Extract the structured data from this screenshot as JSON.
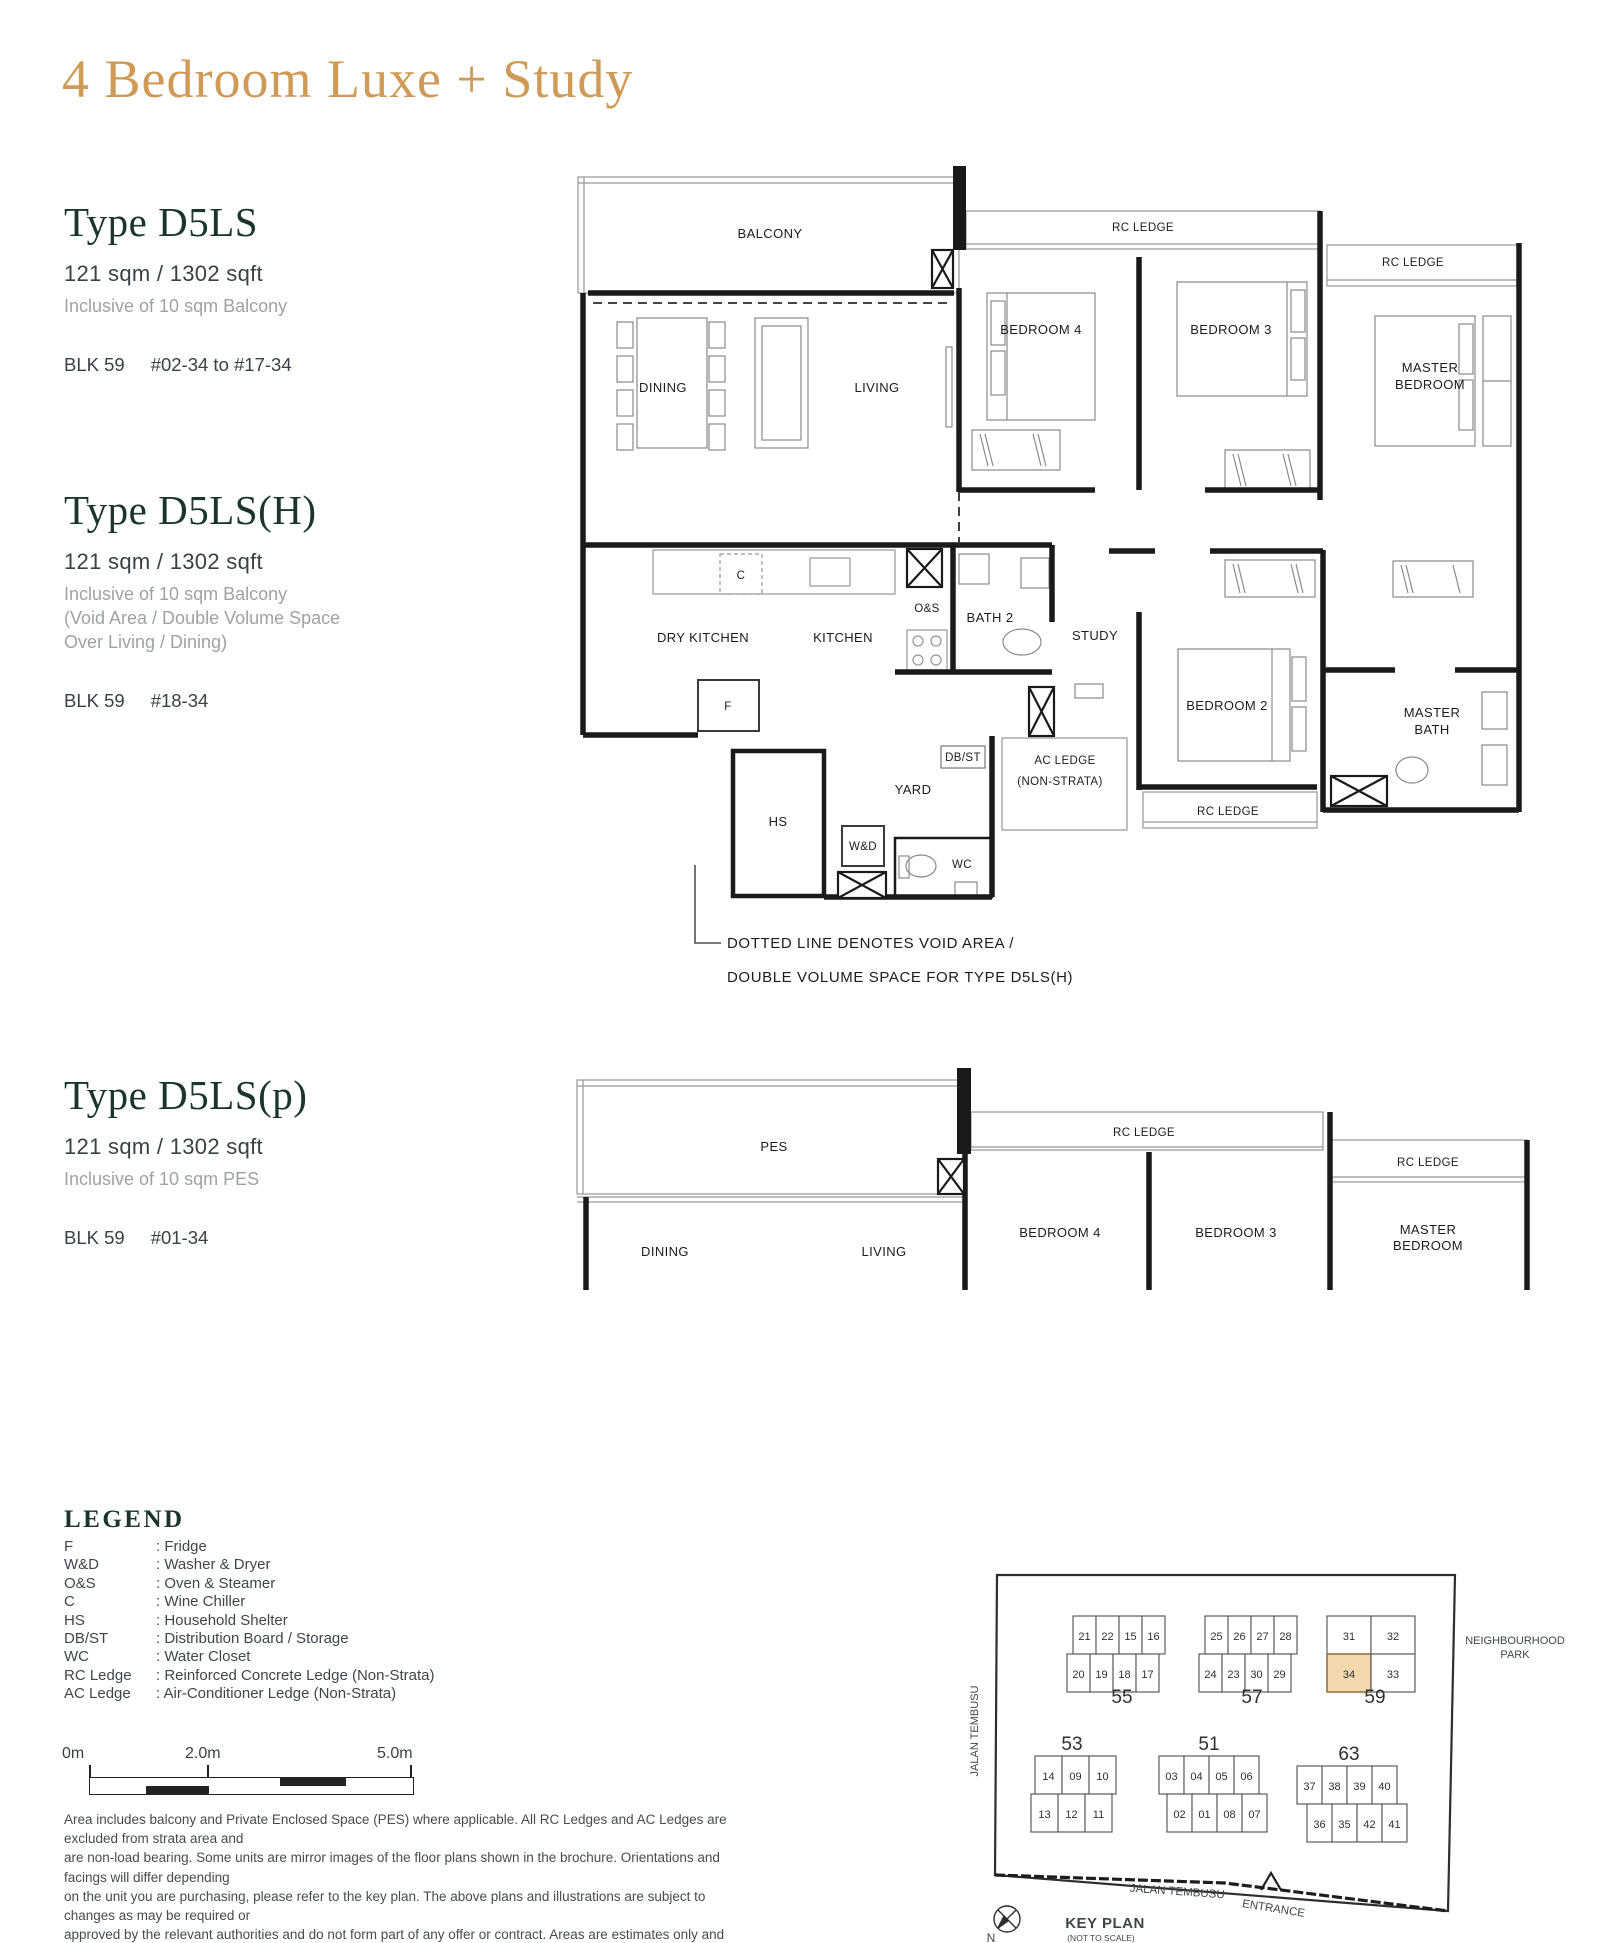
{
  "page": {
    "title": "4 Bedroom Luxe + Study"
  },
  "types": [
    {
      "name": "Type D5LS",
      "area": "121 sqm / 1302 sqft",
      "inc": [
        "Inclusive of 10 sqm Balcony"
      ],
      "blk": "BLK 59",
      "units": "#02-34 to #17-34"
    },
    {
      "name": "Type D5LS(H)",
      "area": "121 sqm / 1302 sqft",
      "inc": [
        "Inclusive of 10 sqm Balcony",
        "(Void Area / Double Volume Space",
        "Over Living / Dining)"
      ],
      "blk": "BLK 59",
      "units": "#18-34"
    },
    {
      "name": "Type D5LS(p)",
      "area": "121 sqm / 1302 sqft",
      "inc": [
        "Inclusive of 10 sqm PES"
      ],
      "blk": "BLK 59",
      "units": "#01-34"
    }
  ],
  "plan1": {
    "balcony": "BALCONY",
    "rc_a": "RC LEDGE",
    "rc_b": "RC LEDGE",
    "rc_c": "RC LEDGE",
    "dining": "DINING",
    "living": "LIVING",
    "bedroom4": "BEDROOM 4",
    "bedroom3": "BEDROOM 3",
    "master1": "MASTER",
    "master2": "BEDROOM",
    "c": "C",
    "os": "O&S",
    "dry_kitchen": "DRY KITCHEN",
    "kitchen": "KITCHEN",
    "bath2": "BATH 2",
    "study": "STUDY",
    "f": "F",
    "dbst": "DB/ST",
    "ac1": "AC LEDGE",
    "ac2": "(NON-STRATA)",
    "yard": "YARD",
    "hs": "HS",
    "wd": "W&D",
    "wc": "WC",
    "bedroom2": "BEDROOM 2",
    "mbath1": "MASTER",
    "mbath2": "BATH",
    "note1": "DOTTED LINE DENOTES VOID AREA /",
    "note2": "DOUBLE VOLUME SPACE FOR TYPE D5LS(H)"
  },
  "plan2": {
    "pes": "PES",
    "rc_a": "RC LEDGE",
    "rc_b": "RC LEDGE",
    "dining": "DINING",
    "living": "LIVING",
    "bedroom4": "BEDROOM 4",
    "bedroom3": "BEDROOM 3",
    "master1": "MASTER",
    "master2": "BEDROOM"
  },
  "legend": {
    "heading": "LEGEND",
    "items": [
      {
        "k": "F",
        "v": ": Fridge"
      },
      {
        "k": "W&D",
        "v": ": Washer & Dryer"
      },
      {
        "k": "O&S",
        "v": ": Oven & Steamer"
      },
      {
        "k": "C",
        "v": ": Wine Chiller"
      },
      {
        "k": "HS",
        "v": ": Household Shelter"
      },
      {
        "k": "DB/ST",
        "v": ": Distribution Board / Storage"
      },
      {
        "k": "WC",
        "v": ": Water Closet"
      },
      {
        "k": "RC Ledge",
        "v": ": Reinforced Concrete Ledge (Non-Strata)"
      },
      {
        "k": "AC Ledge",
        "v": ": Air-Conditioner Ledge (Non-Strata)"
      }
    ]
  },
  "scalebar": {
    "l0": "0m",
    "l1": "2.0m",
    "l2": "5.0m"
  },
  "disclaimer": {
    "lines": [
      "Area includes balcony and Private Enclosed Space (PES) where applicable. All RC Ledges and AC Ledges are excluded from strata area and",
      "are non-load bearing. Some units are mirror images of the floor plans shown in the brochure. Orientations and facings will differ depending",
      "on the unit you are purchasing, please refer to the key plan. The above plans and illustrations are subject to changes as may be required or",
      "approved by the relevant authorities and do not form part of any offer or contract. Areas are estimates only and are subject to final survey.",
      "The balcony & PES shall not be enclosed unless with the approved balcony screen. For an illustration of the approved balcony screen,",
      "please refer to Annex A of this brochure."
    ]
  },
  "keyplan": {
    "highlight": "34",
    "highlight_color": "#f5d9ae",
    "labels": {
      "neigh1": "NEIGHBOURHOOD",
      "neigh2": "PARK",
      "jalan_left": "JALAN TEMBUSU",
      "jalan_bottom": "JALAN TEMBUSU",
      "entrance": "ENTRANCE",
      "keyplan": "KEY PLAN",
      "nts": "(NOT TO SCALE)",
      "north": "N"
    },
    "blocks": [
      {
        "number": "55",
        "row1": [
          "21",
          "22",
          "15",
          "16"
        ],
        "row2": [
          "20",
          "19",
          "18",
          "17"
        ]
      },
      {
        "number": "57",
        "row1": [
          "25",
          "26",
          "27",
          "28"
        ],
        "row2": [
          "24",
          "23",
          "30",
          "29"
        ]
      },
      {
        "number": "59",
        "row1": [
          "31",
          "32"
        ],
        "row2": [
          "34",
          "33"
        ]
      },
      {
        "number": "53",
        "row1": [
          "14",
          "09",
          "10"
        ],
        "row2": [
          "13",
          "12",
          "11"
        ]
      },
      {
        "number": "51",
        "row1": [
          "03",
          "04",
          "05",
          "06"
        ],
        "row2": [
          "02",
          "01",
          "08",
          "07"
        ]
      },
      {
        "number": "63",
        "row1": [
          "37",
          "38",
          "39",
          "40"
        ],
        "row2": [
          "36",
          "35",
          "42",
          "41"
        ]
      }
    ]
  }
}
